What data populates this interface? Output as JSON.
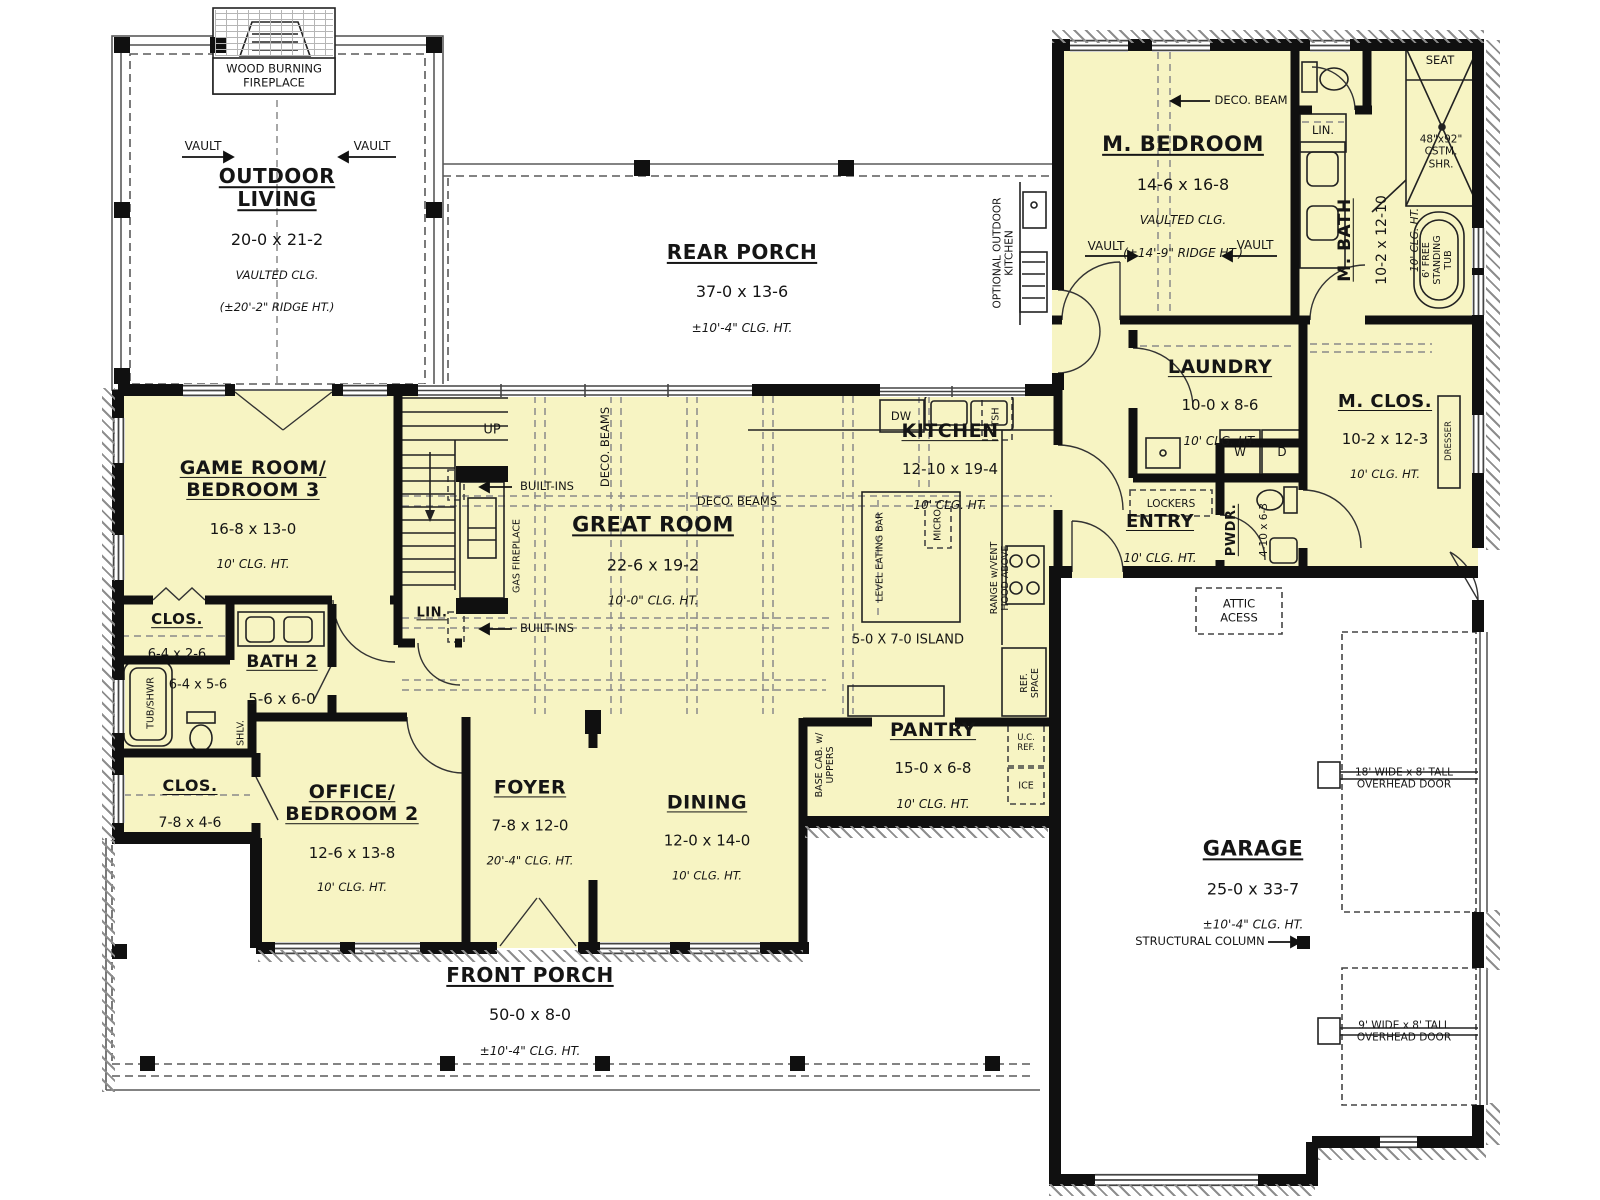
{
  "colors": {
    "room_fill": "#f7f4c3",
    "wall": "#101010",
    "line": "#666666",
    "dash": "#8a8a8a"
  },
  "rooms": {
    "outdoor_living": {
      "name": "OUTDOOR\nLIVING",
      "dims": "20-0 x 21-2",
      "clg": "VAULTED CLG.",
      "note": "(±20'-2\" RIDGE HT.)"
    },
    "rear_porch": {
      "name": "REAR PORCH",
      "dims": "37-0 x 13-6",
      "clg": "±10'-4\" CLG. HT."
    },
    "m_bedroom": {
      "name": "M. BEDROOM",
      "dims": "14-6 x 16-8",
      "clg": "VAULTED CLG.",
      "note": "(±14'-9\" RIDGE HT.)"
    },
    "m_bath": {
      "name": "M. BATH",
      "dims": "10-2 x 12-10",
      "clg": "10' CLG. HT."
    },
    "laundry": {
      "name": "LAUNDRY",
      "dims": "10-0 x 8-6",
      "clg": "10' CLG. HT."
    },
    "m_clos": {
      "name": "M. CLOS.",
      "dims": "10-2 x 12-3",
      "clg": "10' CLG. HT."
    },
    "entry": {
      "name": "ENTRY",
      "clg": "10' CLG. HT."
    },
    "pwdr": {
      "name": "PWDR.",
      "dims": "4-10 x 6-3"
    },
    "kitchen": {
      "name": "KITCHEN",
      "dims": "12-10 x 19-4",
      "clg": "10' CLG. HT."
    },
    "pantry": {
      "name": "PANTRY",
      "dims": "15-0 x 6-8",
      "clg": "10' CLG. HT."
    },
    "great_room": {
      "name": "GREAT ROOM",
      "dims": "22-6 x 19-2",
      "clg": "10'-0\" CLG. HT."
    },
    "game_room": {
      "name": "GAME ROOM/\nBEDROOM 3",
      "dims": "16-8 x 13-0",
      "clg": "10' CLG. HT."
    },
    "hall_closet": {
      "name": "CLOS.",
      "dims": "6-4 x 2-6"
    },
    "bath2": {
      "name": "BATH 2",
      "dims": "5-6 x 6-0",
      "alcove_dims": "6-4 x 5-6"
    },
    "bed2_closet": {
      "name": "CLOS.",
      "dims": "7-8 x 4-6"
    },
    "office": {
      "name": "OFFICE/\nBEDROOM 2",
      "dims": "12-6 x 13-8",
      "clg": "10' CLG. HT."
    },
    "foyer": {
      "name": "FOYER",
      "dims": "7-8 x 12-0",
      "clg": "20'-4\" CLG. HT."
    },
    "dining": {
      "name": "DINING",
      "dims": "12-0 x 14-0",
      "clg": "10' CLG. HT."
    },
    "front_porch": {
      "name": "FRONT PORCH",
      "dims": "50-0 x 8-0",
      "clg": "±10'-4\" CLG. HT."
    },
    "garage": {
      "name": "GARAGE",
      "dims": "25-0 x 33-7",
      "clg": "±10'-4\" CLG. HT."
    }
  },
  "labels": {
    "wood_fireplace": "WOOD BURNING\nFIREPLACE",
    "vault": "VAULT",
    "deco_beam": "DECO. BEAM",
    "deco_beams": "DECO. BEAMS",
    "optional_outdoor_kitchen": "OPTIONAL OUTDOOR\nKITCHEN",
    "lin": "LIN.",
    "seat": "SEAT",
    "custom_shower": "48\"x92\"\nCSTM.\nSHR.",
    "freestanding_tub": "6' FREE\nSTANDING\nTUB",
    "washer": "W",
    "dryer": "D",
    "dresser": "DRESSER",
    "lockers": "LOCKERS",
    "attic_access": "ATTIC\nACESS",
    "up": "UP",
    "built_ins": "BUILT-INS",
    "gas_fireplace": "GAS FIREPLACE",
    "tub_shwr": "TUB/SHWR",
    "shlv": "SHLV.",
    "dw": "DW",
    "tsh": "TSH",
    "level_eating_bar": "LEVEL EATING BAR",
    "micro": "MICRO",
    "island": "5-0 X 7-0 ISLAND",
    "range_hood": "RANGE w/VENT\nHOOD ABOVE",
    "ref_space": "REF.\nSPACE",
    "uc_ref": "U.C.\nREF.",
    "ice": "ICE",
    "base_cab": "BASE CAB. w/\nUPPERS",
    "structural_column": "STRUCTURAL COLUMN",
    "overhead_door_18": "18' WIDE x 8' TALL\nOVERHEAD DOOR",
    "overhead_door_9": "9' WIDE x 8' TALL\nOVERHEAD DOOR"
  }
}
